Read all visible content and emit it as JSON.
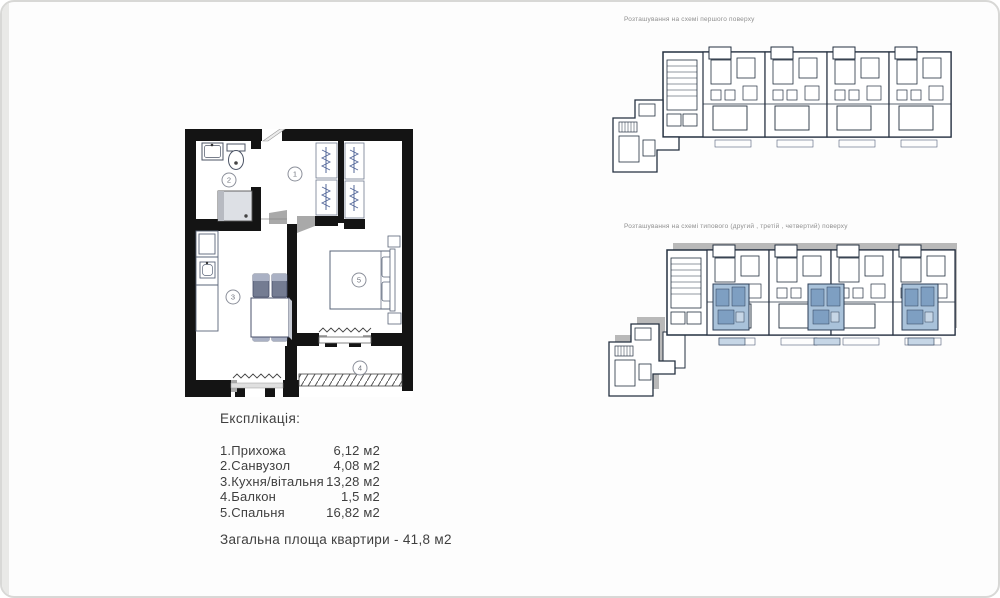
{
  "page": {
    "background": "#fdfdfd",
    "border_color": "#d8d8d6"
  },
  "floor_plan": {
    "wall_color": "#141414",
    "furniture_color": "#5a6478",
    "hanger_color": "#55689a",
    "shadow_color": "#a9a9a9",
    "room_numbers": [
      "1",
      "2",
      "3",
      "4",
      "5"
    ]
  },
  "explication": {
    "title": "Експлікація:",
    "rows": [
      {
        "name": "1.Прихожа",
        "area": "6,12 м2"
      },
      {
        "name": "2.Санвузол",
        "area": "4,08 м2"
      },
      {
        "name": "3.Кухня/вітальня",
        "area": "13,28 м2"
      },
      {
        "name": "4.Балкон",
        "area": "1,5 м2"
      },
      {
        "name": "5.Спальня",
        "area": "16,82 м2"
      }
    ],
    "total": "Загальна площа квартири - 41,8 м2"
  },
  "schemes": [
    {
      "label": "Розташування на схемі першого поверху"
    },
    {
      "label": "Розташування на схемі типового (другий , третій , четвертий) поверху",
      "highlight_color": "#a9c2da"
    }
  ]
}
